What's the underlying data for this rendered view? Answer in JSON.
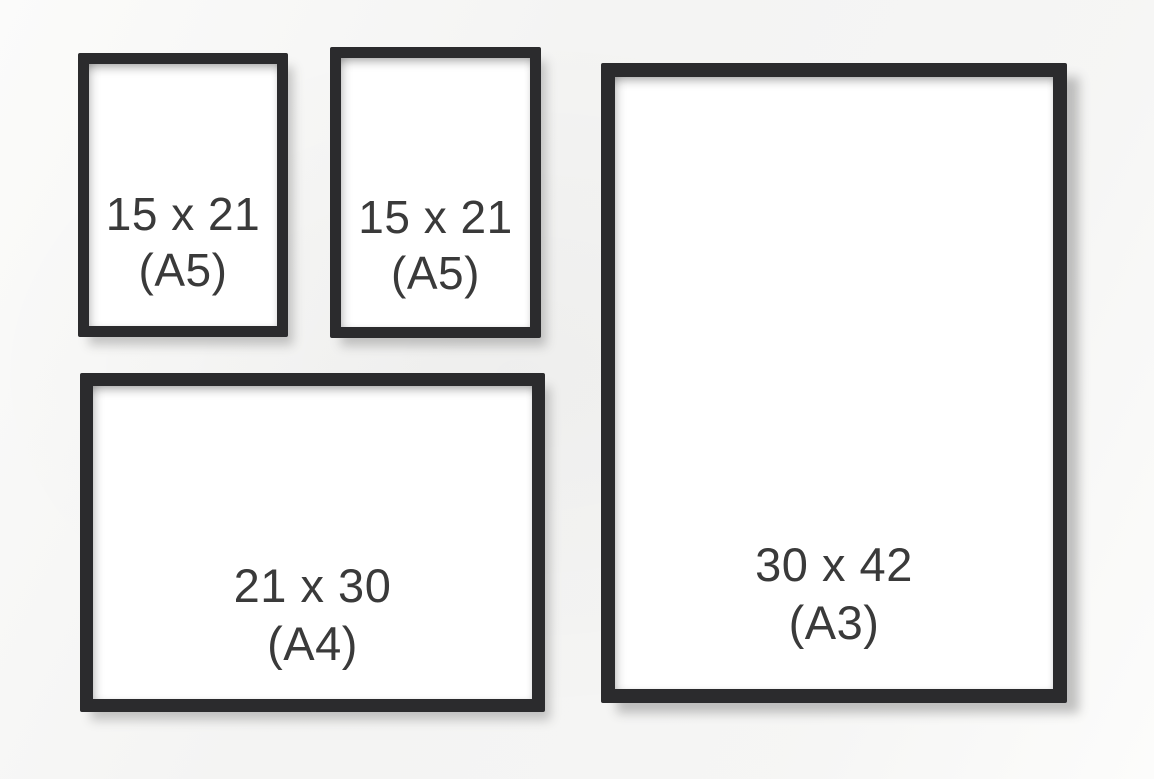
{
  "image": {
    "description": "Size comparison of four black picture frames on a light wall",
    "colors": {
      "background": "#f5f5f4",
      "frame": "#2b2b2d",
      "text": "#3a3a3a"
    }
  },
  "frames": [
    {
      "name": "small-portrait-left",
      "size_label": "15 x 21",
      "format_label": "(A5)"
    },
    {
      "name": "small-portrait-center",
      "size_label": "15 x 21",
      "format_label": "(A5)"
    },
    {
      "name": "landscape-bottom",
      "size_label": "21 x 30",
      "format_label": "(A4)"
    },
    {
      "name": "large-portrait-right",
      "size_label": "30 x 42",
      "format_label": "(A3)"
    }
  ]
}
